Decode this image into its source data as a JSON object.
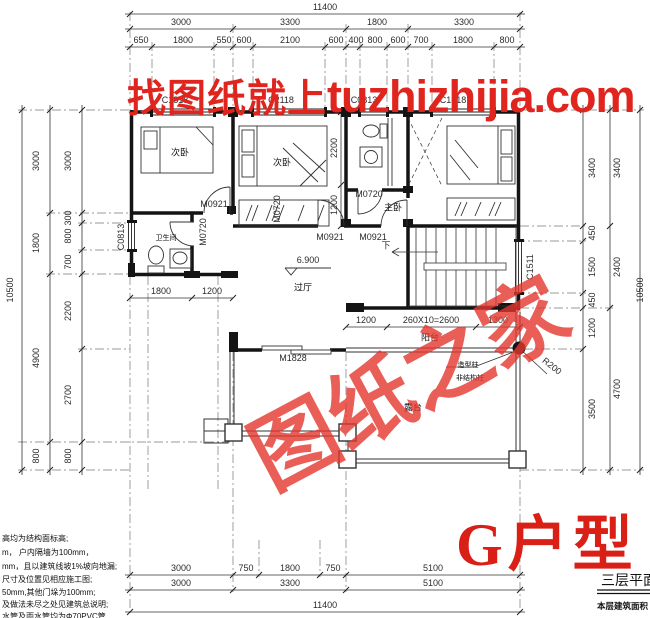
{
  "watermark": {
    "prefix": "找图纸就上",
    "site": "tuzhizhijia.com",
    "stamp": "图纸之家",
    "color": "#e0251f"
  },
  "title": {
    "unit": "G户型",
    "sheet": "三层平面图",
    "area_prefix": "本层建筑面积"
  },
  "rooms": {
    "bed_left": "次卧",
    "bed_mid": "次卧",
    "bed_master": "主卧",
    "bath_left": "卫生间",
    "hall": "过厅",
    "balcony": "阳台",
    "terrace": "露台"
  },
  "elevation": "6.900",
  "stair_down": "下",
  "callouts": {
    "radius": "R200",
    "col_note1": "造型柱",
    "col_note2": "非结构柱"
  },
  "openings": {
    "win_top": [
      "C1818",
      "C2118",
      "C0813",
      "C1818"
    ],
    "win_left": "C0813",
    "win_right": "C1511",
    "door_m0921": "M0921",
    "door_m0720": "M0720",
    "door_m1828": "M1828"
  },
  "dims": {
    "top": {
      "total": "11400",
      "major": [
        "3000",
        "3300",
        "1800",
        "3300"
      ],
      "minor": [
        "650",
        "1800",
        "550",
        "600",
        "2100",
        "600",
        "400",
        "800",
        "600",
        "700",
        "1800",
        "800"
      ]
    },
    "bottom": {
      "total": "11400",
      "major": [
        "3000",
        "3300",
        "5100"
      ],
      "minor": [
        "3000",
        "750",
        "1800",
        "750",
        "5100"
      ]
    },
    "left": {
      "total": "10500",
      "major": [
        "3000",
        "1800",
        "4900",
        "800"
      ],
      "minor": [
        "3000",
        "300",
        "800",
        "700",
        "2200",
        "2700",
        "800"
      ]
    },
    "right": {
      "total": "10500",
      "major": [
        "3400",
        "2400",
        "4700"
      ],
      "minor": [
        "3400",
        "450",
        "1500",
        "450",
        "1200",
        "3500"
      ]
    },
    "interior": {
      "hall_w1": "1800",
      "hall_w2": "1200",
      "bed2_d1": "2200",
      "bed2_d2": "1200",
      "balcony": [
        "1200",
        "260X10=2600",
        "1300"
      ]
    }
  },
  "notes": [
    "高均为结构面标高;",
    "m， 户内隔墙为100mm，",
    "mm，且以建筑线坡1%坡向地漏;",
    "尺寸及位置见相应施工图;",
    "50mm,其他门垛为100mm;",
    "及做法未尽之处见建筑总说明;",
    "水管及雨水管均为Φ70PVC管"
  ]
}
